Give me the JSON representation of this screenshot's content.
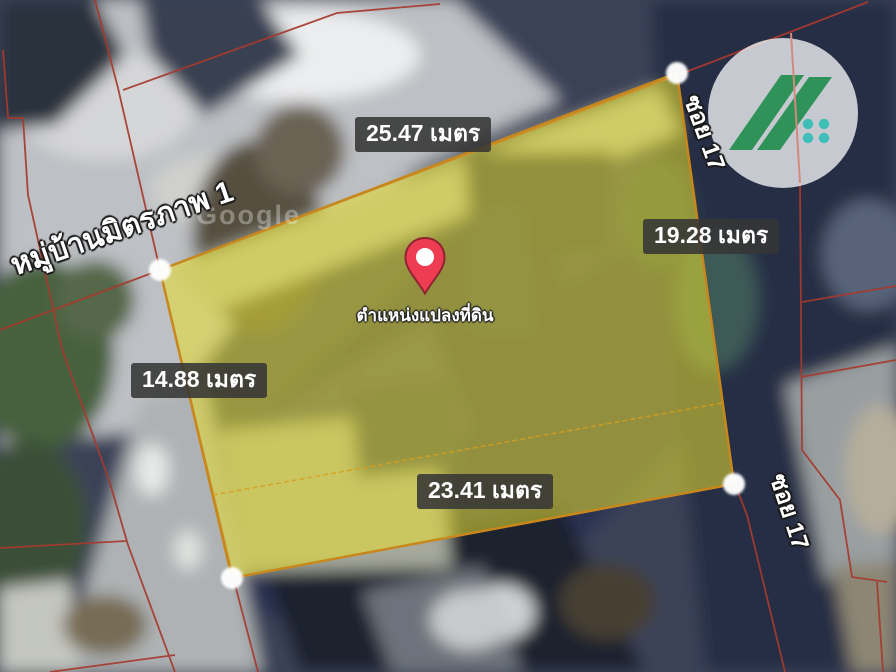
{
  "map": {
    "watermark": "Google",
    "measurements": {
      "top": "25.47 เมตร",
      "right": "19.28 เมตร",
      "left": "14.88 เมตร",
      "bottom": "23.41 เมตร"
    },
    "pin_label": "ตำแหน่งแปลงที่ดิน",
    "streets": {
      "northwest_road": "หมู่บ้านมิตรภาพ 1",
      "east_soi_top": "ซอย 17",
      "east_soi_bottom": "ซอย 17"
    },
    "colors": {
      "parcel_fill": "#e8df2f",
      "parcel_border": "#c8871c",
      "cadastral_line": "#a63a2e",
      "label_bg": "#363636",
      "pin_red": "#ee3d53",
      "logo_green": "#2f9258",
      "logo_teal": "#3fbdb7"
    }
  }
}
